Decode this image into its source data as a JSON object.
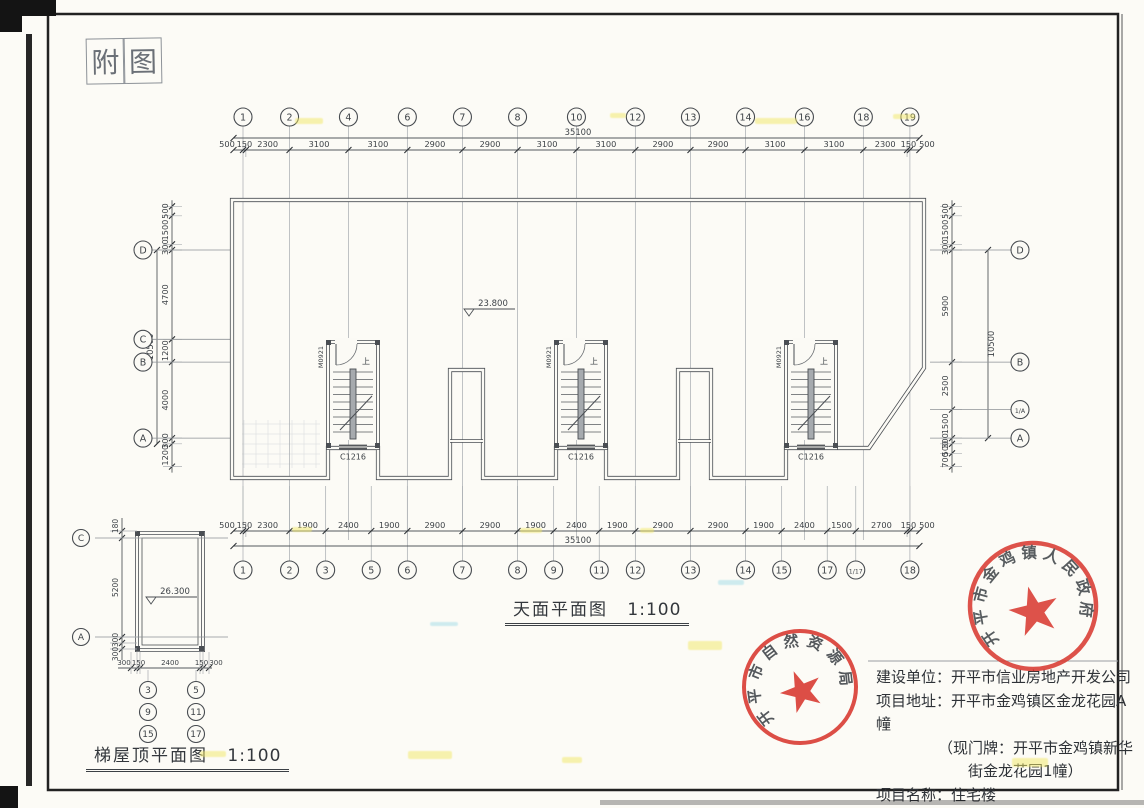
{
  "sheet": {
    "tag_chars": [
      "附",
      "图"
    ]
  },
  "captions": {
    "main": "天面平面图",
    "main_scale": "1:100",
    "small": "梯屋顶平面图",
    "small_scale": "1:100"
  },
  "plan": {
    "elevation_main": "23.800",
    "elevation_small": "26.300",
    "door_label": "M0921",
    "window_label": "C1216",
    "up_label": "上"
  },
  "axes": {
    "top": {
      "overall": "35100",
      "end_left": "500",
      "end_right": "500",
      "dims": [
        "150",
        "2300",
        "3100",
        "3100",
        "2900",
        "2900",
        "3100",
        "3100",
        "2900",
        "2900",
        "3100",
        "3100",
        "2300",
        "150"
      ],
      "bubbles": [
        {
          "label": "1",
          "tick": 0
        },
        {
          "label": "2",
          "tick": 2
        },
        {
          "label": "4",
          "tick": 3
        },
        {
          "label": "6",
          "tick": 4
        },
        {
          "label": "7",
          "tick": 5
        },
        {
          "label": "8",
          "tick": 6
        },
        {
          "label": "10",
          "tick": 7
        },
        {
          "label": "12",
          "tick": 8
        },
        {
          "label": "13",
          "tick": 9
        },
        {
          "label": "14",
          "tick": 10
        },
        {
          "label": "16",
          "tick": 11
        },
        {
          "label": "18",
          "tick": 12
        },
        {
          "label": "19",
          "tick": 14
        }
      ]
    },
    "bottom": {
      "overall": "35100",
      "end_left": "500",
      "end_right": "500",
      "dims": [
        "150",
        "2300",
        "1900",
        "2400",
        "1900",
        "2900",
        "2900",
        "1900",
        "2400",
        "1900",
        "2900",
        "2900",
        "1900",
        "2400",
        "1500",
        "2700",
        "150"
      ],
      "bubbles": [
        {
          "label": "1",
          "tick": 0
        },
        {
          "label": "2",
          "tick": 2
        },
        {
          "label": "3",
          "tick": 3
        },
        {
          "label": "5",
          "tick": 4
        },
        {
          "label": "6",
          "tick": 5
        },
        {
          "label": "7",
          "tick": 6
        },
        {
          "label": "8",
          "tick": 7
        },
        {
          "label": "9",
          "tick": 8
        },
        {
          "label": "11",
          "tick": 9
        },
        {
          "label": "12",
          "tick": 10
        },
        {
          "label": "13",
          "tick": 11
        },
        {
          "label": "14",
          "tick": 12
        },
        {
          "label": "15",
          "tick": 13
        },
        {
          "label": "17",
          "tick": 14
        },
        {
          "label": "1/17",
          "tick": 15
        },
        {
          "label": "18",
          "tick": 17
        }
      ]
    },
    "left": {
      "overall": "10500",
      "dims": [
        "500",
        "1500",
        "300",
        "4700",
        "1200",
        "4000",
        "300",
        "1200"
      ],
      "bubbles": [
        {
          "label": "D",
          "tick": 3
        },
        {
          "label": "C",
          "tick": 4
        },
        {
          "label": "B",
          "tick": 5
        },
        {
          "label": "A",
          "tick": 6
        }
      ]
    },
    "right": {
      "overall": "10500",
      "dims": [
        "500",
        "1500",
        "300",
        "5900",
        "2500",
        "1500",
        "300",
        "500",
        "700"
      ],
      "bubbles": [
        {
          "label": "D",
          "tick": 3
        },
        {
          "label": "B",
          "tick": 4
        },
        {
          "label": "1/A",
          "tick": 5
        },
        {
          "label": "A",
          "tick": 6
        }
      ]
    },
    "small_left": {
      "dims": [
        "180",
        "5200",
        "300",
        "300"
      ],
      "bubbles": [
        {
          "label": "C",
          "tick": 1
        },
        {
          "label": "A",
          "tick": 2
        }
      ]
    },
    "small_bottom": {
      "dims": [
        "300",
        "150",
        "2400",
        "150",
        "300"
      ],
      "bubble_cols": [
        {
          "labels": [
            "3",
            "9",
            "15"
          ]
        },
        {
          "labels": [
            "5",
            "11",
            "17"
          ]
        }
      ]
    }
  },
  "stamps": [
    {
      "text": "开平市金鸡镇人民政府"
    },
    {
      "text": "开平市自然资源局"
    }
  ],
  "info_block": {
    "lines": [
      {
        "text": "建设单位：开平市信业房地产开发公司"
      },
      {
        "text": "项目地址：开平市金鸡镇区金龙花园A幢"
      },
      {
        "text": "（现门牌：开平市金鸡镇新华"
      },
      {
        "text": "街金龙花园1幢）"
      },
      {
        "text": "项目名称：住宅楼"
      }
    ]
  },
  "colors": {
    "stamp_red": "#d8372e",
    "ink": "#4a4e53",
    "paper": "#fbfaf5",
    "grid": "#abafb3"
  }
}
